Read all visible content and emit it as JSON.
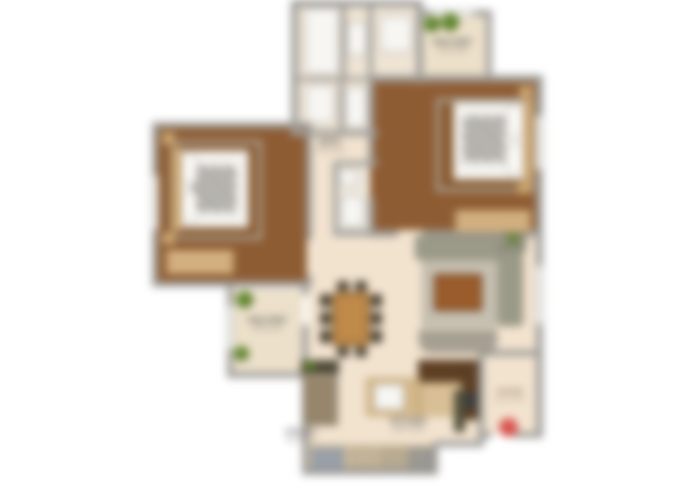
{
  "plan_title": "2 BHK Apartment Floor Plan",
  "colors": {
    "wall": "#9f9d99",
    "floor_wood": "#8e5c33",
    "floor_cream": "#f2e3cf",
    "floor_balcony": "#ece0ca",
    "floor_bath": "#efe4d4",
    "wardrobe": "#d8b584",
    "counter_dark": "#5e3f24",
    "counter_tan": "#d3b88c",
    "sofa": "#9b9a88",
    "rug_gray": "#c6c0b2",
    "rug_wood": "#8a5a30",
    "rug_border": "#a9a295",
    "table_wood": "#c08a49",
    "chair_dark": "#4c4335",
    "plant": "#6f9a36",
    "plant_dark": "#44601f",
    "entry_red": "#d9534f",
    "bed_white": "#f4f2ee",
    "fixture": "#f7f6f3",
    "text": "#4a4a4a"
  },
  "rooms": {
    "balcony_top": {
      "label": "BALCONY",
      "dim": "5'0 x 6'0"
    },
    "bath": {
      "label": "BATH",
      "dim": "7'5 x 5'0"
    },
    "balcony_bottom": {
      "label": "BALCONY",
      "dim": "8'0 x 5'0"
    },
    "utility": {
      "label": "UTILITY",
      "dim": "6'0 x 3'0"
    },
    "kitchen": {
      "label": "KITCHEN",
      "dim": "10'0 x 8'0"
    },
    "foyer": {
      "label": "FOYER",
      "dim": "6'0 x 4'0"
    }
  },
  "icons": {
    "entrance_marker": "red-dot",
    "plants": "green-circle"
  }
}
